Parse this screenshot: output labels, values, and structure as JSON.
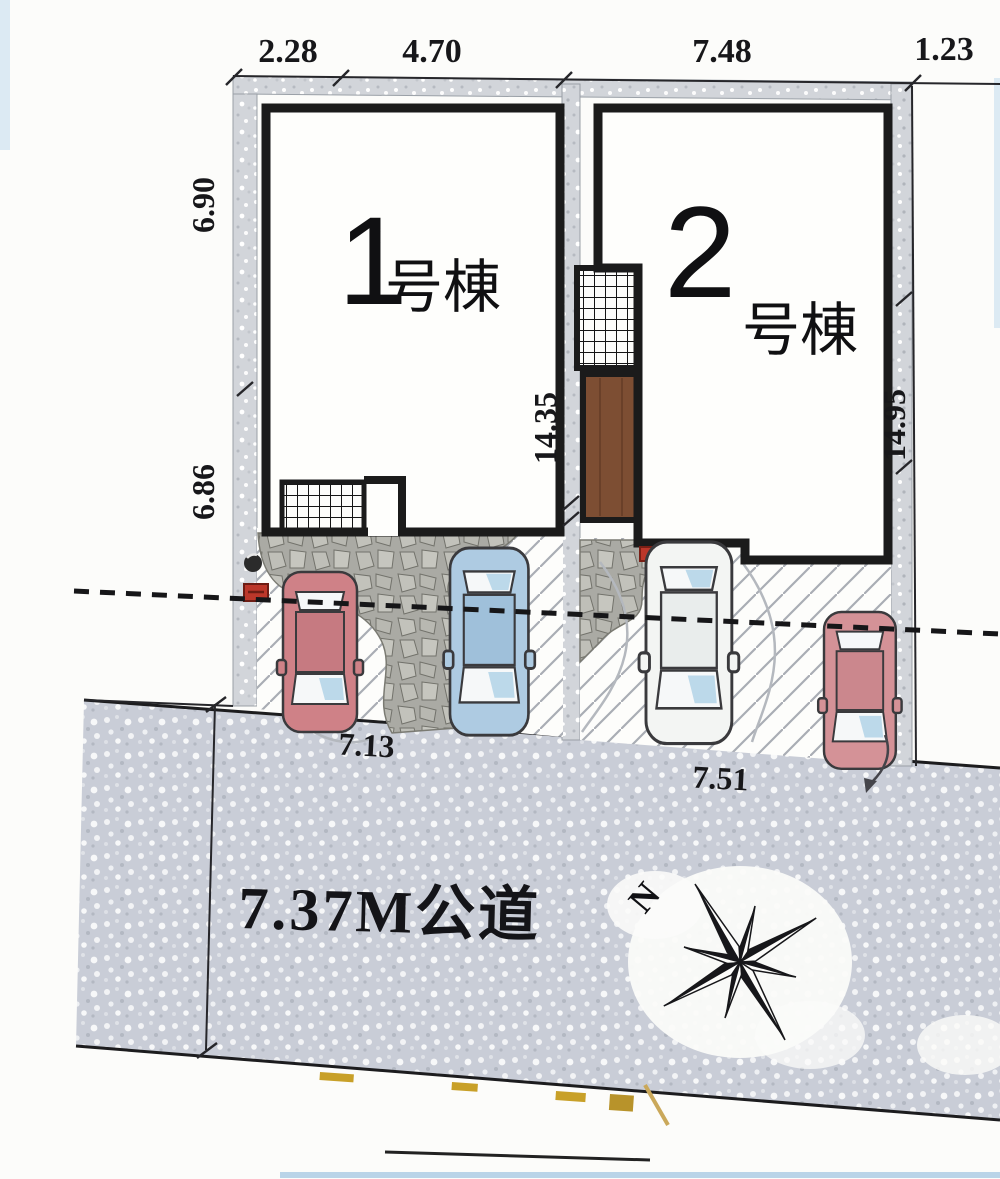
{
  "dims": {
    "top": [
      "2.28",
      "4.70",
      "7.48",
      "1.23"
    ],
    "left_upper": "6.90",
    "left_lower": "6.86",
    "center_depth": "14.35",
    "right_depth": "14.95",
    "frontage_lot1": "7.13",
    "frontage_lot2": "7.51"
  },
  "buildings": [
    {
      "number": "1",
      "suffix": "号棟"
    },
    {
      "number": "2",
      "suffix": "号棟"
    }
  ],
  "road": {
    "label": "7.37M公道"
  },
  "compass": {
    "north": "N"
  },
  "colors": {
    "car_red_body": "#cf8187",
    "car_red_roof": "#c67a81",
    "car_blue_body": "#aecbe2",
    "car_blue_roof": "#9fc0da",
    "car_white_body": "#f3f5f3",
    "car_white_roof": "#e9edec",
    "car_pink_body": "#d49297",
    "car_pink_roof": "#cb878d",
    "glass_blue": "#bcd9ea",
    "deck_brown": "#7d4e33",
    "meter_red": "#bc372a",
    "road_base": "#c9cdd7"
  }
}
